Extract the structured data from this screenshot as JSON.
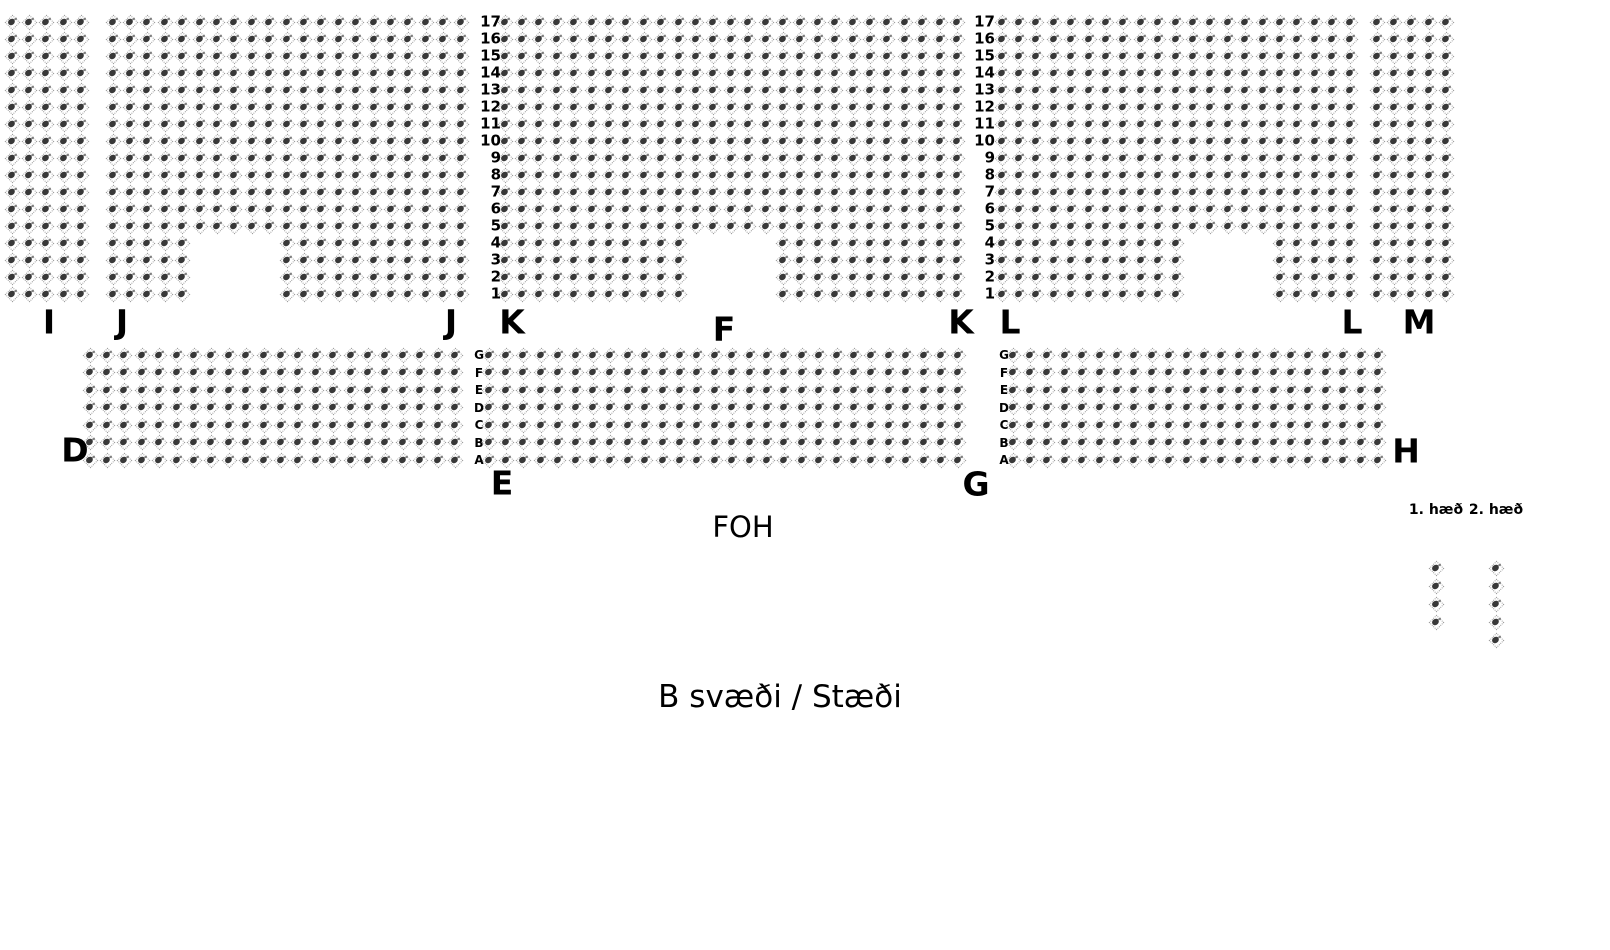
{
  "title": "B svæði / Stæði seating chart",
  "colors": {
    "background": "#ffffff",
    "seat_outline": "#9b9b9b",
    "seat_fill": "#383838",
    "text": "#000000"
  },
  "stage": {
    "foh_label": "FOH",
    "area_label": "B svæði / Stæði"
  },
  "top_band": {
    "row_count": 17,
    "row_numbers": [
      "17",
      "16",
      "15",
      "14",
      "13",
      "12",
      "11",
      "10",
      "9",
      "8",
      "7",
      "6",
      "5",
      "4",
      "3",
      "2",
      "1"
    ],
    "y_start": 22,
    "pitch_y": 17,
    "number_columns": [
      {
        "x": 501
      },
      {
        "x": 995
      }
    ],
    "sections": [
      {
        "name": "I",
        "x_start": 12,
        "cols": 5,
        "pitch_x": 17.4,
        "notch": null,
        "labels": [
          {
            "text": "I",
            "x": 49,
            "y": 322
          }
        ]
      },
      {
        "name": "J",
        "x_start": 113,
        "cols": 21,
        "pitch_x": 17.4,
        "notch": {
          "bottom_rows": 4,
          "col_from": 6,
          "col_to": 10
        },
        "labels": [
          {
            "text": "J",
            "x": 122,
            "y": 322
          },
          {
            "text": "J",
            "x": 451,
            "y": 322
          }
        ]
      },
      {
        "name": "K",
        "x_start": 505,
        "cols": 27,
        "pitch_x": 17.4,
        "notch": {
          "bottom_rows": 4,
          "col_from": 12,
          "col_to": 16
        },
        "labels": [
          {
            "text": "K",
            "x": 512,
            "y": 322
          },
          {
            "text": "K",
            "x": 961,
            "y": 322
          }
        ]
      },
      {
        "name": "L",
        "x_start": 1002,
        "cols": 21,
        "pitch_x": 17.4,
        "notch": {
          "bottom_rows": 4,
          "col_from": 12,
          "col_to": 16
        },
        "labels": [
          {
            "text": "L",
            "x": 1010,
            "y": 322
          },
          {
            "text": "L",
            "x": 1352,
            "y": 322
          }
        ]
      },
      {
        "name": "M",
        "x_start": 1377,
        "cols": 5,
        "pitch_x": 17.4,
        "notch": null,
        "labels": [
          {
            "text": "M",
            "x": 1419,
            "y": 322
          }
        ]
      }
    ]
  },
  "lower_band": {
    "row_count": 7,
    "row_letters": [
      "G",
      "F",
      "E",
      "D",
      "C",
      "B",
      "A"
    ],
    "y_start": 355,
    "pitch_y": 17.5,
    "letter_columns": [
      {
        "x": 479
      },
      {
        "x": 1004
      }
    ],
    "sections": [
      {
        "name": "D",
        "x_start": 90,
        "cols": 22,
        "pitch_x": 17.4,
        "notch": null,
        "labels": [
          {
            "text": "D",
            "x": 75,
            "y": 450
          }
        ]
      },
      {
        "name": "E-F-G",
        "x_start": 489,
        "cols": 28,
        "pitch_x": 17.4,
        "notch": null,
        "labels": [
          {
            "text": "E",
            "x": 502,
            "y": 483
          },
          {
            "text": "F",
            "x": 724,
            "y": 329
          },
          {
            "text": "G",
            "x": 976,
            "y": 484
          }
        ]
      },
      {
        "name": "G-H",
        "x_start": 1013,
        "cols": 22,
        "pitch_x": 17.4,
        "notch": null,
        "labels": [
          {
            "text": "H",
            "x": 1406,
            "y": 451
          }
        ]
      }
    ]
  },
  "balcony": {
    "floor1_label": "1. hæð",
    "floor2_label": "2. hæð",
    "columns": [
      {
        "name": "1. hæð",
        "x": 1436,
        "y_start": 568,
        "count": 4,
        "pitch_y": 18
      },
      {
        "name": "2. hæð",
        "x": 1496,
        "y_start": 568,
        "count": 5,
        "pitch_y": 18
      }
    ]
  }
}
